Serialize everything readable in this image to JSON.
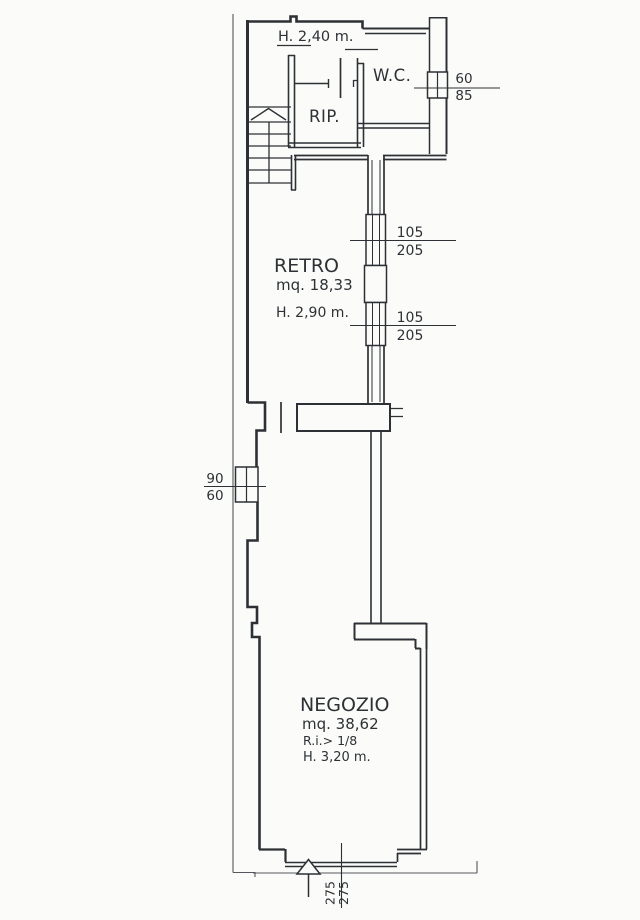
{
  "document": {
    "kind": "scanned architectural floor plan",
    "colors": {
      "ink": "#2d3136",
      "paper": "#fbfbf9"
    }
  },
  "labels": {
    "upper_height": "H.  2,40  m."
  },
  "rooms": {
    "wc": {
      "label": "W.C."
    },
    "rip": {
      "label": "RIP."
    },
    "retro": {
      "label": "RETRO",
      "area": "mq.  18,33",
      "height": "H.  2,90  m."
    },
    "negozio": {
      "label": "NEGOZIO",
      "area": "mq.  38,62",
      "reaeration": "R.i.>  1/8",
      "height": "H.  3,20  m."
    }
  },
  "dimensions": {
    "wc_window": {
      "over": "60",
      "under": "85"
    },
    "retro_window_1": {
      "over": "105",
      "under": "205"
    },
    "retro_window_2": {
      "over": "105",
      "under": "205"
    },
    "side_window": {
      "over": "90",
      "under": "60"
    },
    "entrance": {
      "first": "275",
      "second": "275"
    }
  }
}
